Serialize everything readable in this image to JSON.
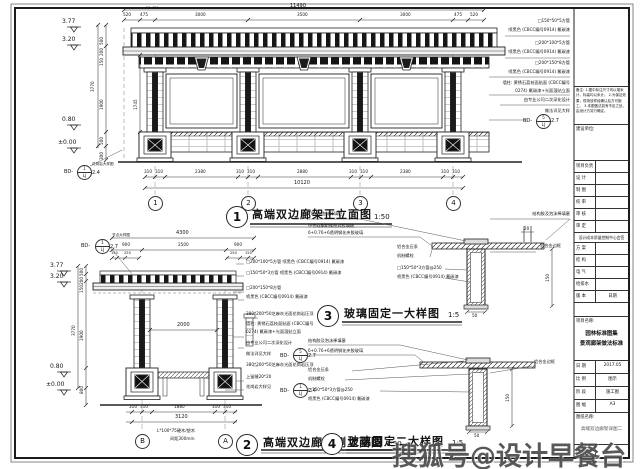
{
  "watermark": "搜狐号@设计早餐台",
  "front": {
    "num": "1",
    "title": "高端双边廊架正立面图",
    "scale": "1:50",
    "dim_total_top": "11490",
    "dim_total_bottom": "10120",
    "top_small": "50 400",
    "top_dims": [
      "520",
      "475",
      "3000",
      "3500",
      "3000",
      "475",
      "520"
    ],
    "bottom_dims": [
      "310",
      "310",
      "2380",
      "310",
      "310",
      "2880",
      "310",
      "310",
      "2380",
      "310",
      "310"
    ],
    "levels": [
      "3.77",
      "3.20",
      "0.80",
      "±0.00"
    ],
    "vdims": {
      "overall": "3770",
      "a": "500",
      "b": "200",
      "c": "150",
      "mid": "1900",
      "d": "500",
      "e": "300",
      "col": "1745"
    },
    "grid": [
      "1",
      "2",
      "3",
      "4"
    ],
    "ann": {
      "l1": "□150*50*5方管",
      "l2": "喷黑色 (CBCC编号0914) 氟碳漆",
      "l3": "□200*100*5方管",
      "l4": "喷黑色 (CBCC编号0914) 氟碳漆",
      "l5": "□200*150*8方管",
      "l6": "喷黑色 (CBCC编号0914) 氟碳漆",
      "l7": "墙柱: 黄锈石荔枝面贴面 (CBCC编号",
      "l8": "0274) 氟碳漆+光面湿贴立面",
      "l9": "由专业公司二次深化设计",
      "l10": "做法详见大样"
    },
    "ref_right": {
      "prefix": "BD-",
      "num": "5",
      "code": "LJ",
      "suffix": "2.7"
    },
    "ref_left": {
      "prefix": "BD-",
      "num": "1",
      "code": "LJ",
      "suffix": "2.4",
      "note": "花岗岩大样图"
    }
  },
  "side": {
    "num": "2",
    "title": "高端双边廊架侧立面图",
    "scale": "1:50",
    "dim_total_top": "4300",
    "top_dims": [
      "900",
      "2500",
      "900"
    ],
    "small_dims": [
      "150",
      "250",
      "250",
      "150"
    ],
    "mid_dim": "2000",
    "levels": [
      "3.77",
      "3.20",
      "0.80",
      "±0.00"
    ],
    "vdims": {
      "overall": "3770",
      "a": "500",
      "b": "200",
      "c": "150",
      "mid": "1900",
      "base": "800"
    },
    "bottom_dims": [
      "310",
      "310",
      "1880",
      "310",
      "310"
    ],
    "dim_total_bottom": "3120",
    "grid": [
      "B",
      "A"
    ],
    "wood_note": "L*100*75硬木/塑木",
    "wood_gap": "间距300mm",
    "ref_top": {
      "prefix": "BD-",
      "num": "1",
      "code": "LJ",
      "suffix": "2.7",
      "note": "节点大样图"
    },
    "ann": {
      "l1": "□200*100*5方管 喷黑色 (CBCC编号0914) 氟碳漆",
      "l2": "□150*50*3方管 喷黑色 (CBCC编号0914) 氟碳漆",
      "l3": "□200*150*8方管",
      "l4": "喷黑色 (CBCC编号0914) 氟碳漆",
      "l5": "380*200*50芝麻灰光面花岗岩压顶",
      "l6": "墙柱: 黄锈石荔枝面贴面 (CBCC编号",
      "l7": "0274) 氟碳漆+光面湿贴立面",
      "l8": "由专业公司二次深化设计",
      "l9": "做法详见大样",
      "l10": "380*200*50芝麻灰光面花岗岩压顶",
      "l11": "上留缝20*20",
      "l12": "花岗岩大样见"
    },
    "ref_mid": {
      "prefix": "BD-",
      "num": "5",
      "code": "LJ",
      "suffix": "2.7"
    },
    "ref_bot": {
      "prefix": "BD-",
      "num": "1",
      "code": "LJ",
      "suffix": "2.4"
    }
  },
  "detail3": {
    "num": "3",
    "title": "玻璃固定一大样图",
    "scale": "1:5",
    "ann": {
      "t1": "10mm泡沫棒填充",
      "t2": "中性硅酮耐候密封胶填缝",
      "t3": "6+0.76+6透明钢化夹胶玻璃",
      "tr": "结构胶及泡沫棒填塞",
      "l1": "铝合金压条",
      "l2": "机制螺栓",
      "l3": "□150*50*3方管@250",
      "l4": "喷黑色 (CBCC编号0914) 氟碳漆",
      "r1": "铝合金边框"
    },
    "dims": {
      "h": "150",
      "w": "50",
      "t": "20"
    }
  },
  "detail4": {
    "num": "4",
    "title": "玻璃固定二大样图",
    "scale": "1:5",
    "ann": {
      "t1": "结构胶及泡沫棒填塞",
      "t2": "6+0.76+6透明钢化夹胶玻璃",
      "l1": "铝合金压条",
      "l2": "机制螺栓",
      "l3": "□150*50*3方管@250",
      "l4": "喷黑色 (CBCC编号0914) 氟碳漆",
      "r1": "铝合金边框"
    },
    "dims": {
      "h": "150",
      "w": "50"
    }
  },
  "titleblock": {
    "notes_label": "备注:",
    "notes": [
      "1.图中标注尺寸均以毫米计，标高均以米计。",
      "2.为保证效果，现场放样经确认后方可施工。",
      "3.本图做法如有不足之处，由设计方另行确定。"
    ],
    "client_label": "建设单位:",
    "sign_rows": [
      "项目负责",
      "设  计",
      "制  图",
      "校  审",
      "审  核",
      "审  定"
    ],
    "countersign": "设计成本质量控制中心会签",
    "cs_rows": [
      "方  案",
      "结  构",
      "电  气",
      "给排水"
    ],
    "version_label": "版  本",
    "date_label": "日期",
    "project_label": "项目名称:",
    "project_name1": "园林标准图集",
    "project_name2": "景观廊架做法标准",
    "info_rows": [
      {
        "k": "日  期",
        "v": "2017.05"
      },
      {
        "k": "比  例",
        "v": "图示"
      },
      {
        "k": "阶  段",
        "v": "施工图"
      },
      {
        "k": "图  幅",
        "v": "A3"
      }
    ],
    "drawing_label": "图纸名称:",
    "drawing_name": "高端双边廊架详图二",
    "number_label": "图纸编号"
  }
}
